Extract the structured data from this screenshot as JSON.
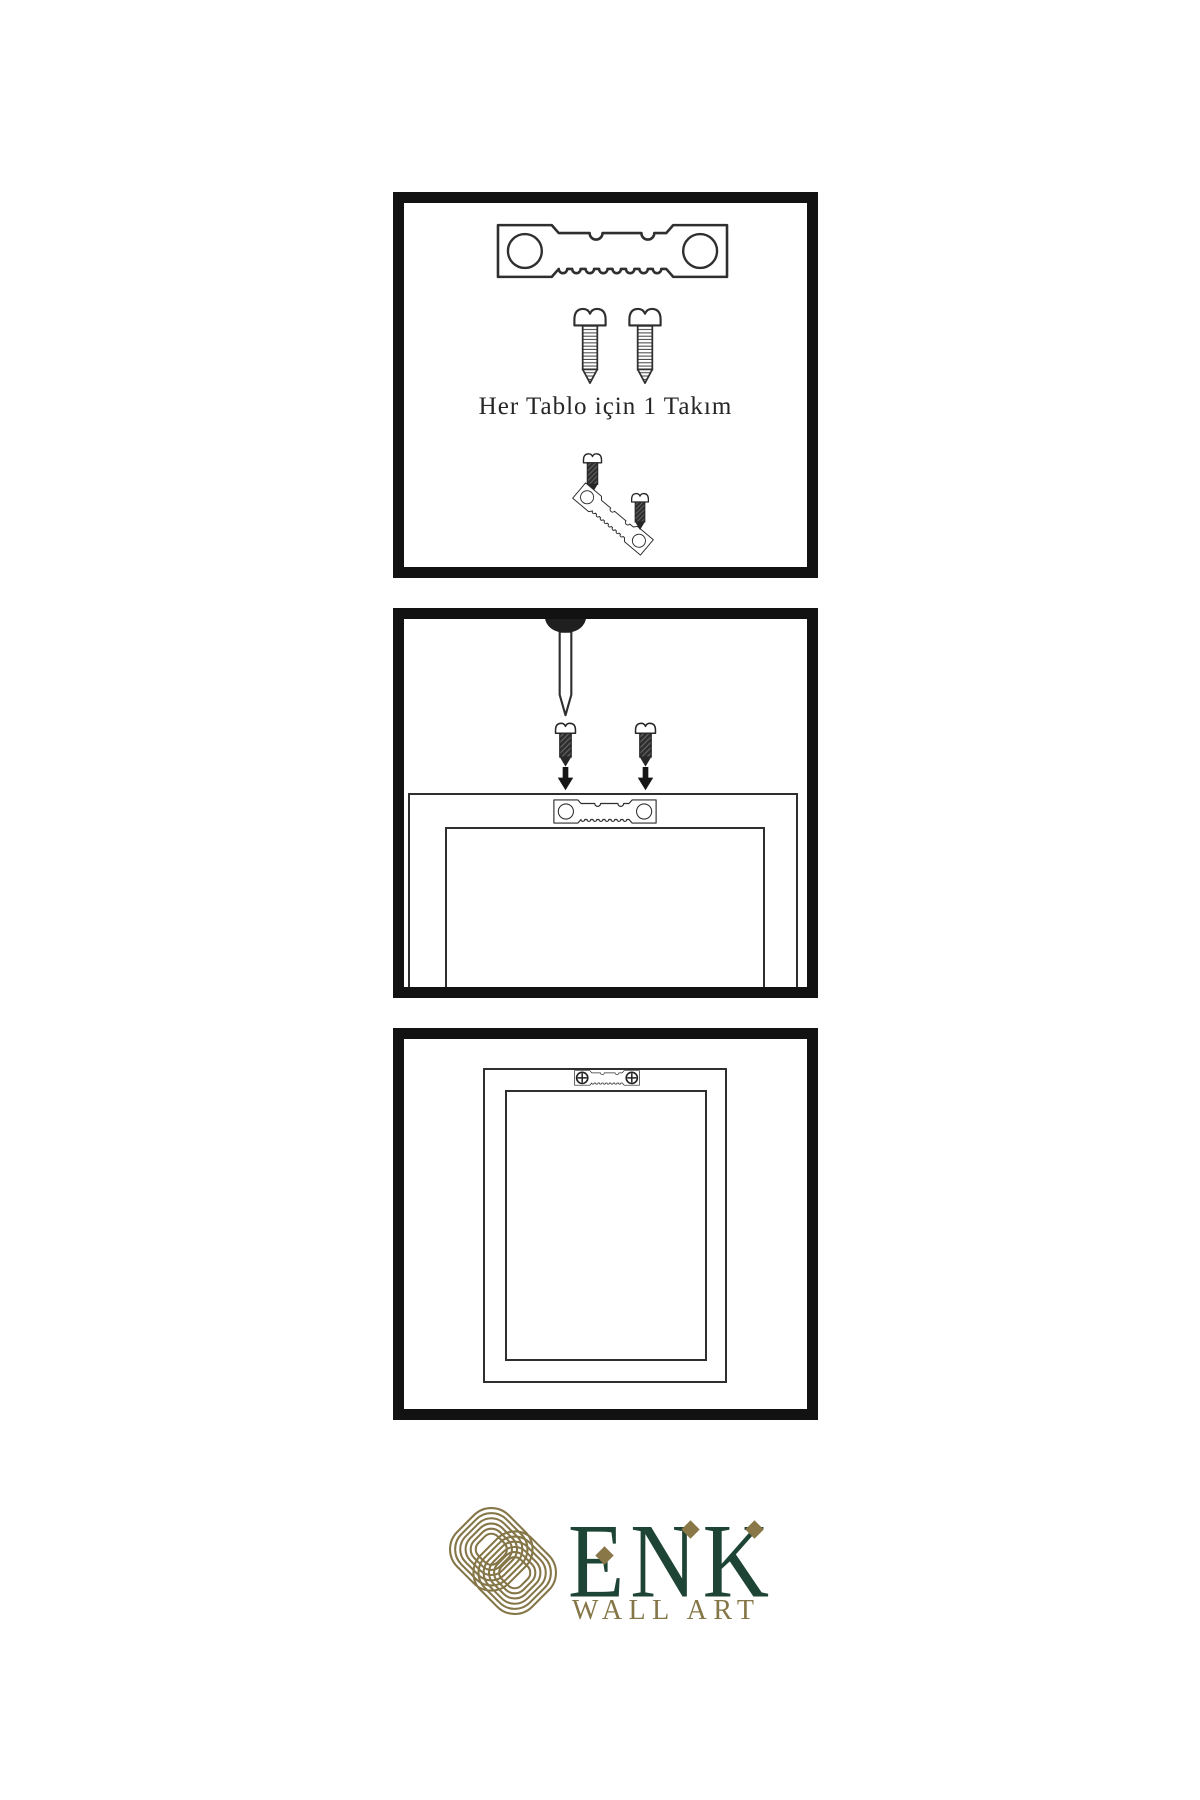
{
  "page": {
    "background": "#ffffff"
  },
  "steps": {
    "step1": {
      "caption": "Her Tablo için 1 Takım"
    },
    "step2": {
      "caption": ""
    },
    "step3": {
      "caption": ""
    }
  },
  "brand": {
    "name": "ENK",
    "subtitle": "WALL ART",
    "color_green": "#1d4434",
    "color_gold": "#857647",
    "color_diamond": "#8a7748"
  },
  "icons": {
    "sawtooth_hanger": "sawtooth-hanger-icon",
    "screw_threaded": "threaded-screw-icon",
    "screw_dark": "dark-screw-icon",
    "nail": "nail-icon",
    "arrow_down": "arrow-down-icon",
    "mounted_hanger": "mounted-sawtooth-hanger-icon",
    "knot": "knot-logo-icon"
  }
}
